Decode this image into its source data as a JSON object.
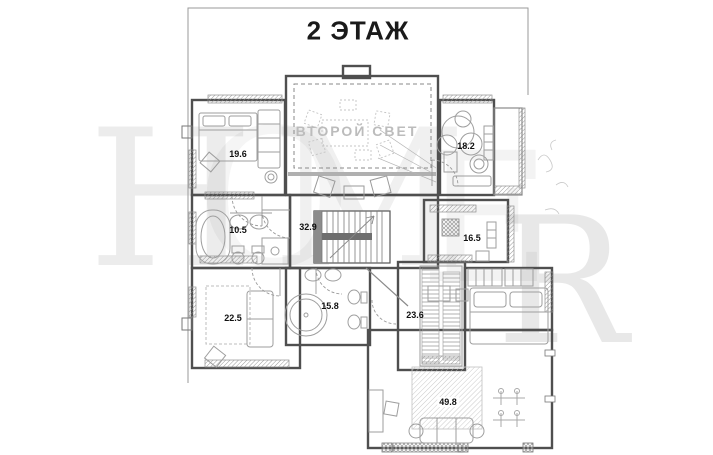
{
  "title": "2 ЭТАЖ",
  "second_light_label": "ВТОРОЙ СВЕТ",
  "watermark": {
    "letters": [
      "H",
      "O",
      "M",
      "E",
      "R"
    ]
  },
  "rooms": [
    {
      "name": "bedroom-top-left",
      "area": "19.6"
    },
    {
      "name": "winter-garden",
      "area": "18.2"
    },
    {
      "name": "bathroom-left",
      "area": "10.5"
    },
    {
      "name": "stair-hall",
      "area": "32.9"
    },
    {
      "name": "cabinet-right",
      "area": "16.5"
    },
    {
      "name": "bedroom-bottom-left",
      "area": "22.5"
    },
    {
      "name": "bathroom-center",
      "area": "15.8"
    },
    {
      "name": "wardrobe-room",
      "area": "23.6"
    },
    {
      "name": "master-bedroom",
      "area": "49.8"
    }
  ],
  "colors": {
    "background": "#ffffff",
    "walls": "#4f4f4f",
    "furniture": "#9e9e9e",
    "labels": "#111111",
    "second_light_text": "#bcbcbc",
    "frame": "#9a9a9a"
  }
}
